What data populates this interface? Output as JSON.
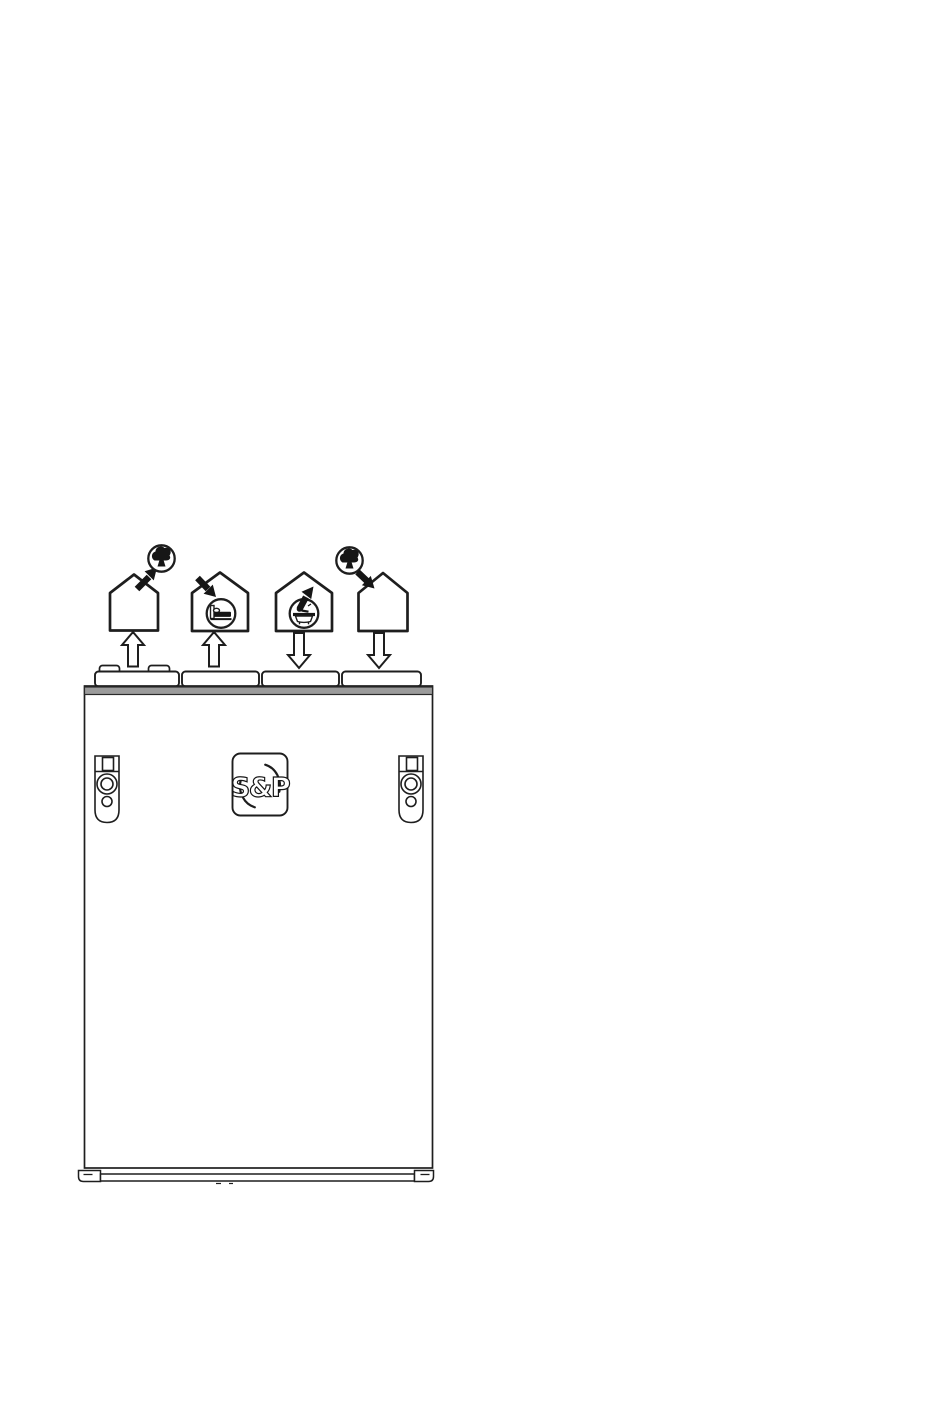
{
  "page": {
    "background_color": "#ffffff",
    "description": "Line-art installation diagram of a heat recovery ventilation unit showing the four top duct connections and their corresponding airflow destinations"
  },
  "diagram": {
    "unit": {
      "logo_text": "S&P",
      "colors": {
        "line": "#1e1e1e",
        "panel_fill": "#ffffff",
        "top_band": "#9b9b9b"
      },
      "parts": {
        "duct_spigots_count": 4,
        "mounting_brackets_count": 2,
        "logo_plate": "rounded square with S&P lettering and two swirl arcs",
        "bottom": "base rail with left and right corner feet"
      }
    },
    "ports": [
      {
        "position": 1,
        "duct_arrow_direction": "up",
        "house_icon": "empty-house",
        "house_symbol_icon": "tree-outdoor-icon",
        "flow_arrow": "from house roof up-right to outdoor tree circle",
        "meaning": "exhaust air from house to outdoors"
      },
      {
        "position": 2,
        "duct_arrow_direction": "up",
        "house_icon": "house-with-bed-circle",
        "house_symbol_icon": "bed-icon",
        "flow_arrow": "down-right into bedroom circle",
        "meaning": "supply air into living/bedroom"
      },
      {
        "position": 3,
        "duct_arrow_direction": "down",
        "house_icon": "house-with-bathtub-circle",
        "house_symbol_icon": "bathtub-icon",
        "flow_arrow": "up-right out of bathroom circle toward roof",
        "meaning": "extract air from wet room"
      },
      {
        "position": 4,
        "duct_arrow_direction": "down",
        "house_icon": "empty-house",
        "house_symbol_icon": "tree-outdoor-icon",
        "flow_arrow": "from outdoor tree circle down-right into house roof",
        "meaning": "fresh air from outdoors into unit"
      }
    ]
  }
}
